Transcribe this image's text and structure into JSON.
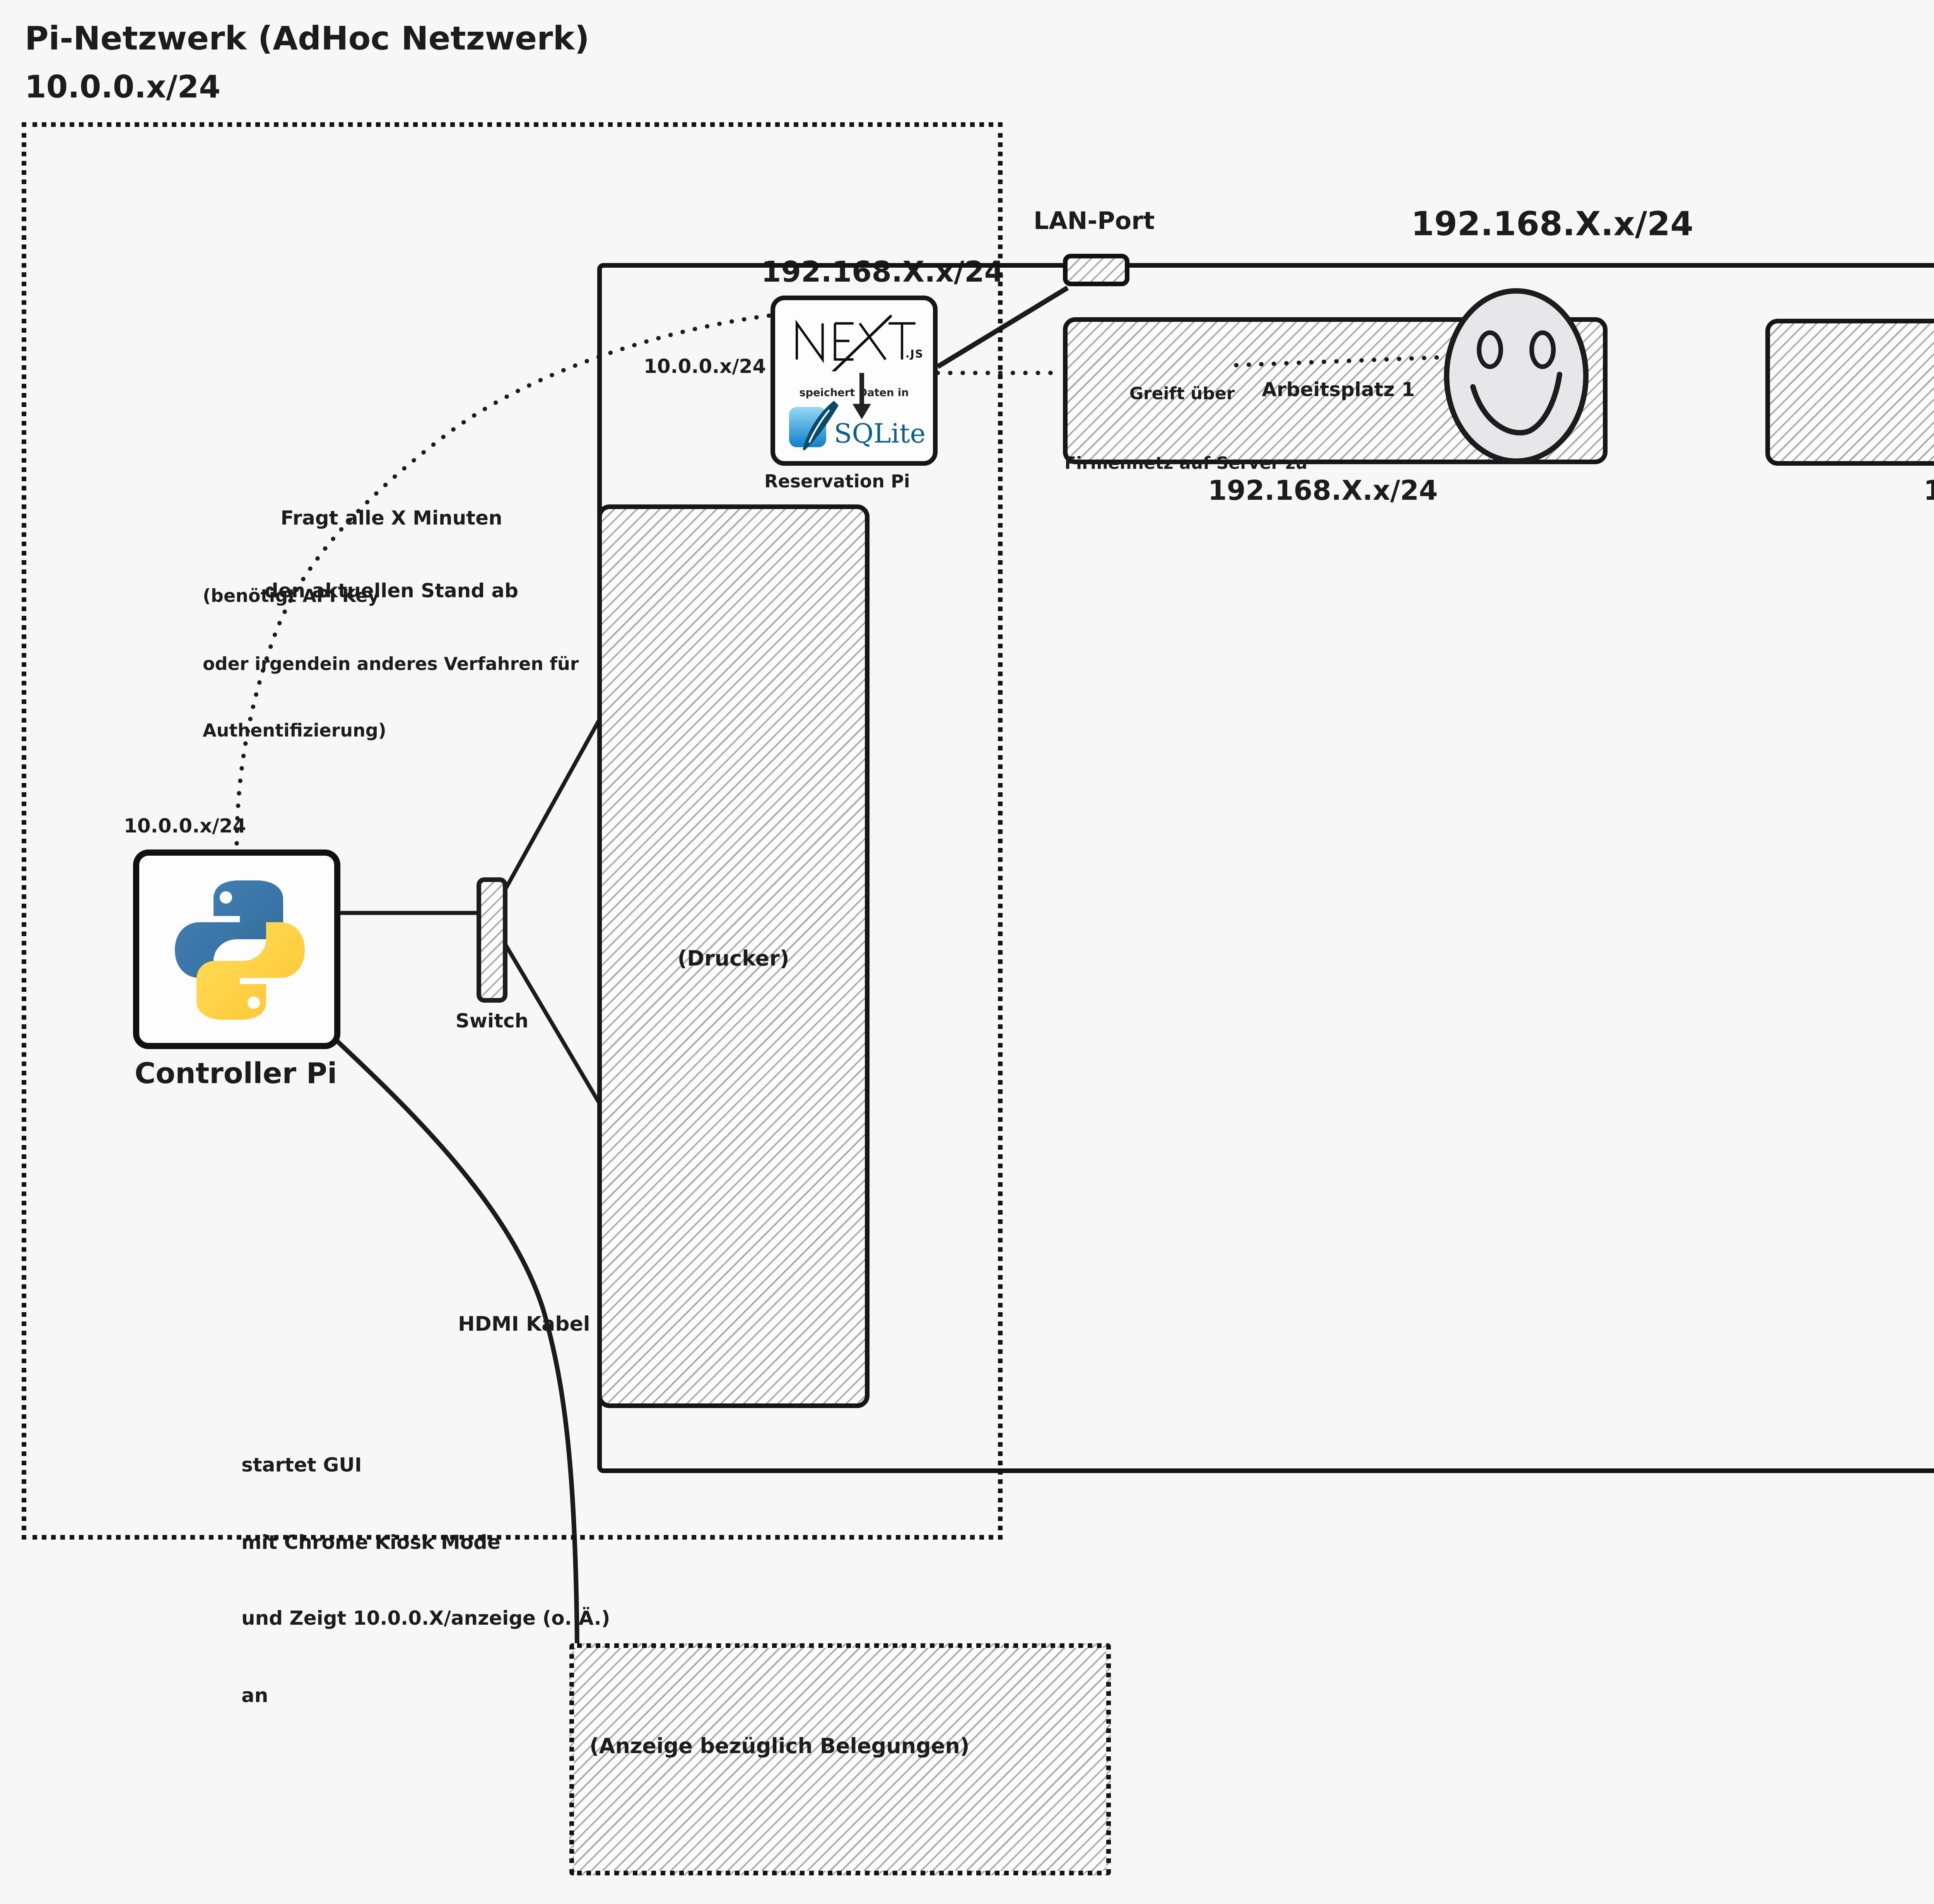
{
  "colors": {
    "background": "#f7f7f8",
    "stroke": "#1a1a1a",
    "python_blue": "#3b77a9",
    "python_yellow": "#ffd648",
    "sqlite_blue": "#0f80cc",
    "sqlite_dark": "#0b5d8a",
    "face_fill": "#e7e7e9"
  },
  "header": {
    "title": "Pi-Netzwerk (AdHoc Netzwerk)",
    "subnet": "10.0.0.x/24"
  },
  "networks": {
    "lan_port_label": "LAN-Port",
    "firmennetz_top": "192.168.X.x/24",
    "above_reservation": "192.168.X.x/24",
    "below_arbeitsplatz1": "192.168.X.x/24",
    "below_arbeitsplatz2": "192.168.X.x/24",
    "reservation_side": "10.0.0.x/24",
    "controller_side": "10.0.0.x/24"
  },
  "nodes": {
    "reservation_pi": {
      "label": "Reservation Pi",
      "logo_suffix": ".JS",
      "middle_text": "speichert Daten in",
      "db_label": "SQLite"
    },
    "controller_pi": {
      "label": "Controller Pi"
    },
    "switch": {
      "label": "Switch"
    },
    "drucker": {
      "label": "(Drucker)"
    },
    "arbeitsplatz1": {
      "label": "Arbeitsplatz 1"
    },
    "arbeitsplatz2": {
      "label": "Arbeitsplatz 2"
    },
    "anzeige": {
      "label": "(Anzeige bezüglich Belegungen)"
    }
  },
  "annotations": {
    "fragt": [
      "Fragt alle X Minuten",
      "den aktuellen Stand ab"
    ],
    "benoetigt": [
      "(benötigt API Key",
      "oder irgendein anderes Verfahren für",
      "Authentifizierung)"
    ],
    "greift": [
      "Greift über",
      "Firmennetz auf Server zu"
    ],
    "hdmi": "HDMI Kabel",
    "startet": [
      "startet GUI",
      "mit Chrome Kiosk Mode",
      "und Zeigt 10.0.0.X/anzeige (o. Ä.)",
      "an"
    ]
  }
}
